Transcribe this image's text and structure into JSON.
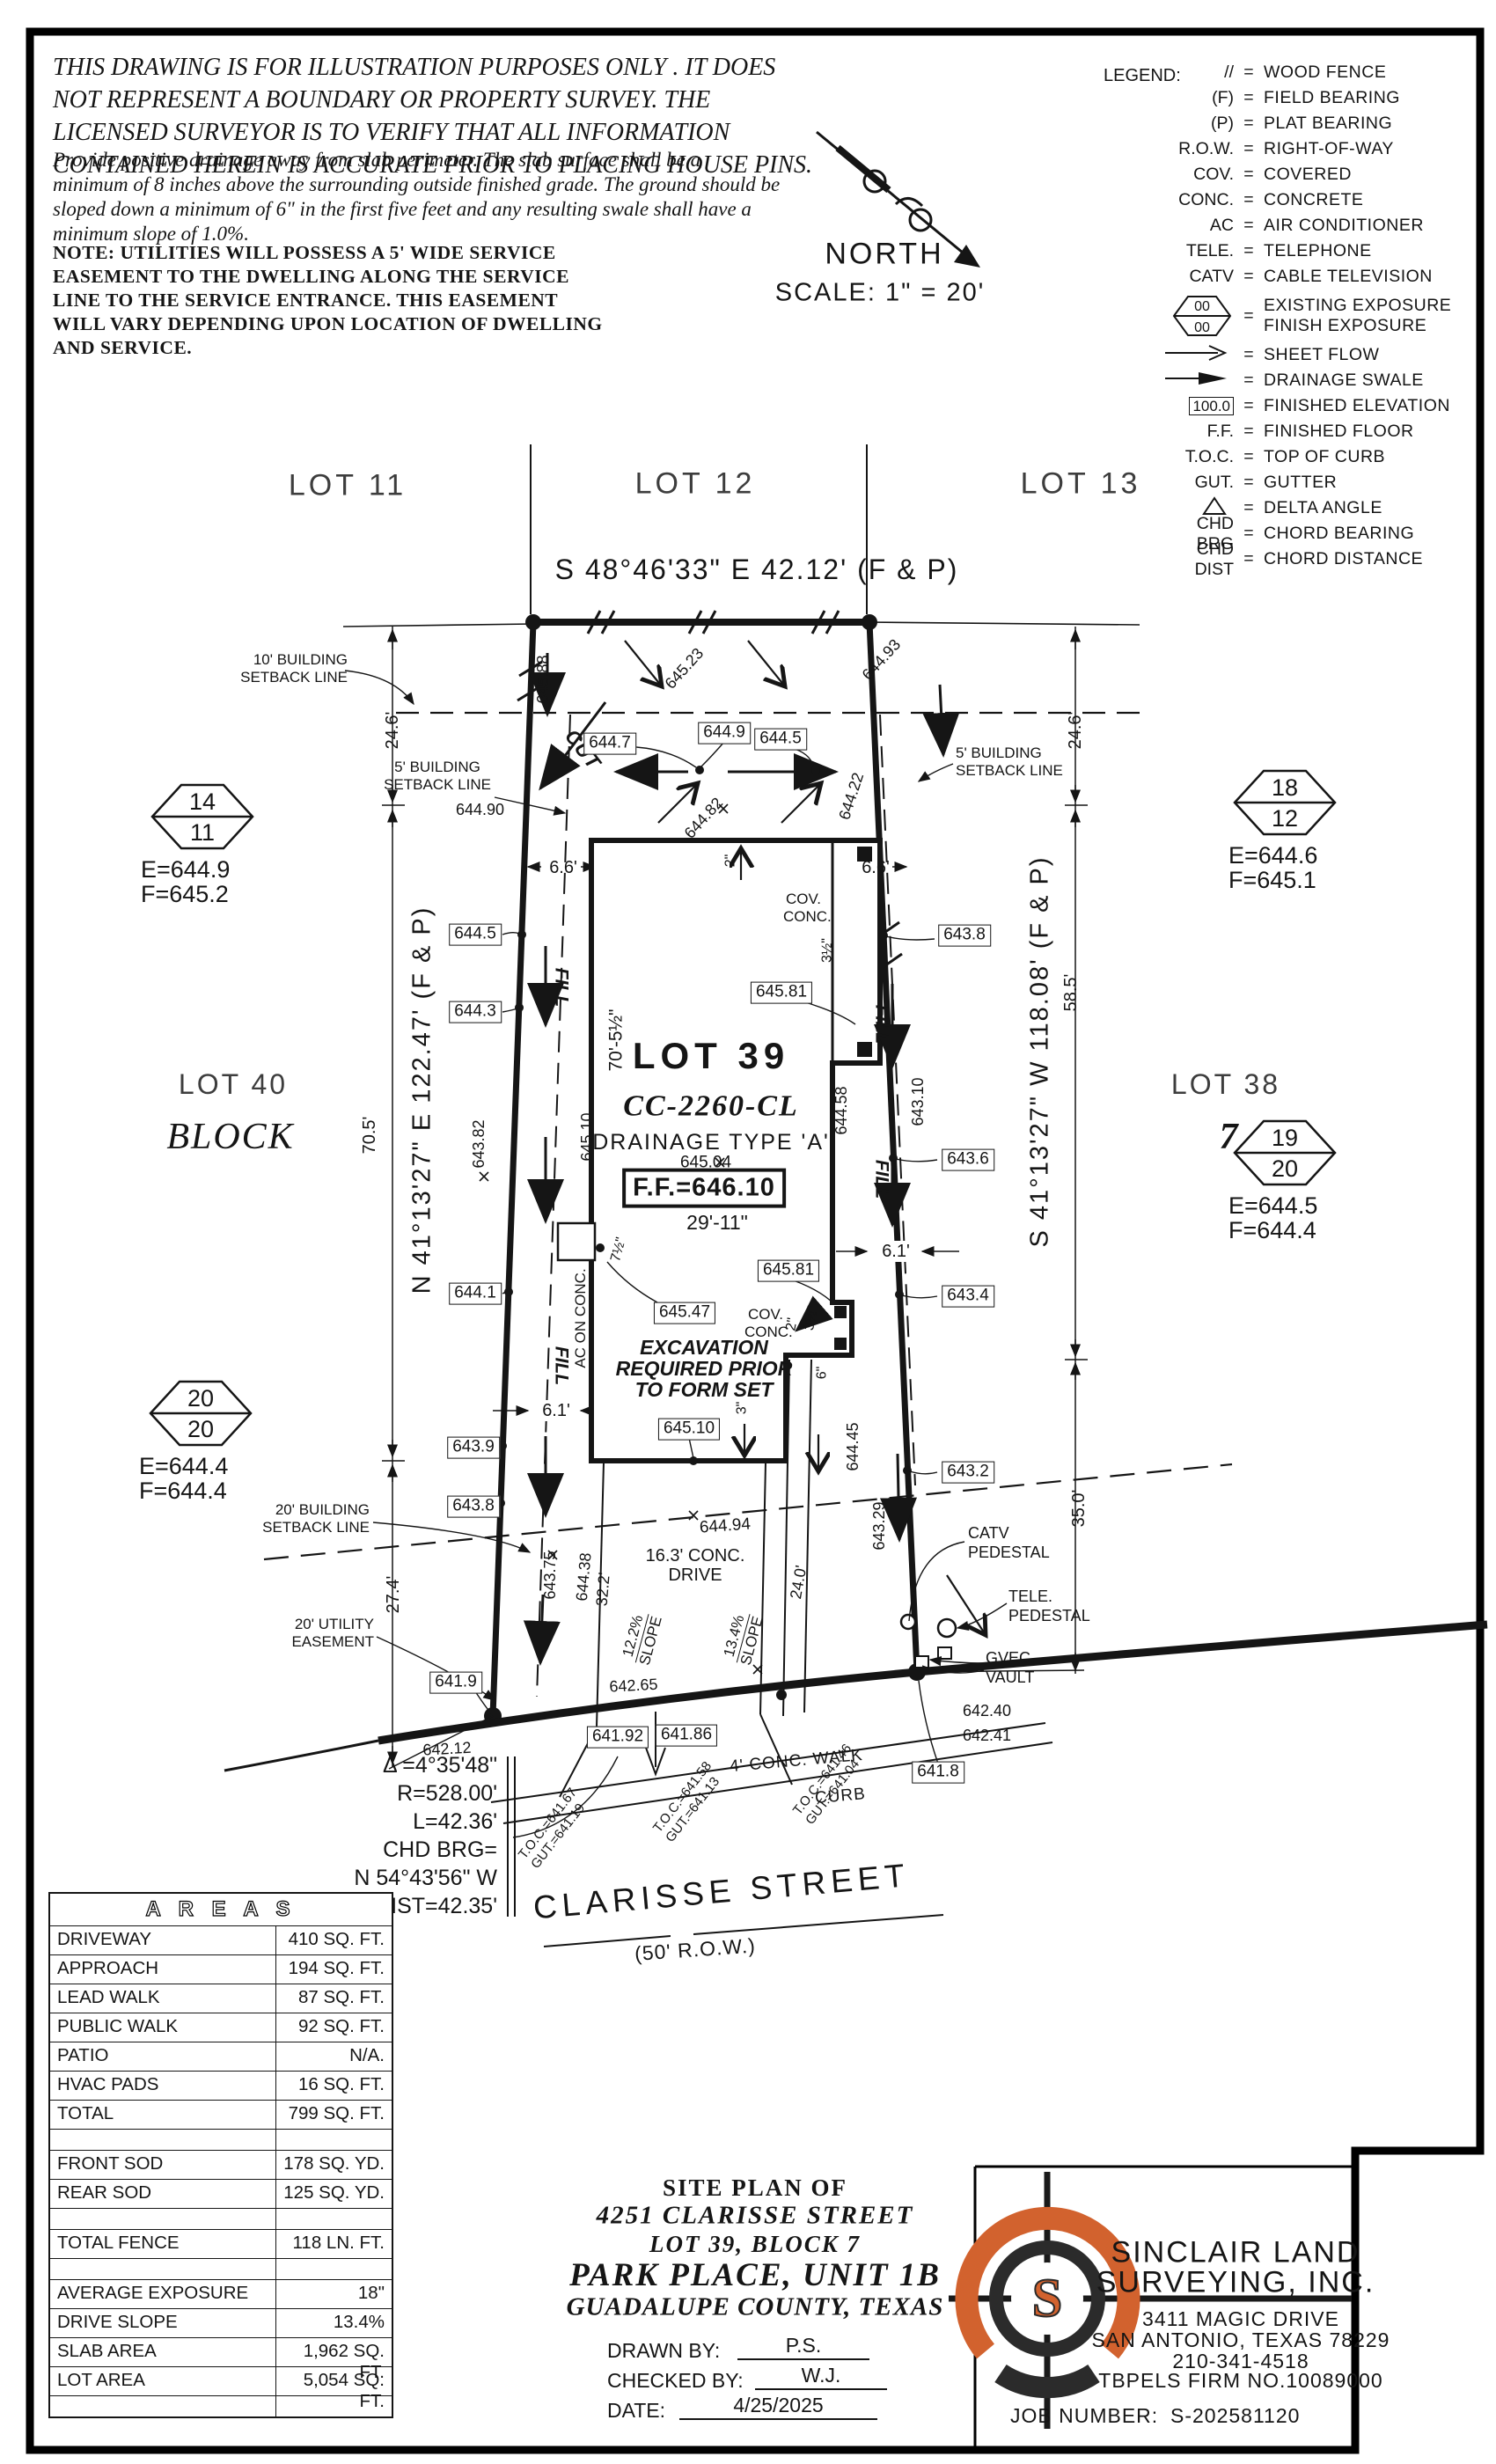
{
  "disclaimer": {
    "p1": [
      "THIS DRAWING IS FOR ILLUSTRATION PURPOSES ONLY . IT DOES",
      "NOT REPRESENT A BOUNDARY OR PROPERTY SURVEY. THE",
      "LICENSED SURVEYOR IS TO VERIFY THAT ALL INFORMATION",
      "CONTAINED HEREIN IS ACCURATE PRIOR TO PLACING HOUSE PINS."
    ],
    "p2": [
      "Provide positive drainage away from slab perimeter. The slab surface shall be a",
      "minimum of 8 inches above the surrounding outside finished grade. The ground should be",
      "sloped down a minimum of 6\" in the first five feet and any resulting swale shall have a",
      "minimum slope of 1.0%."
    ],
    "p3": [
      "NOTE: UTILITIES WILL POSSESS A 5' WIDE SERVICE",
      "EASEMENT TO THE DWELLING ALONG THE SERVICE",
      "LINE TO THE SERVICE ENTRANCE. THIS EASEMENT",
      "WILL VARY DEPENDING UPON LOCATION OF DWELLING",
      "AND SERVICE."
    ]
  },
  "north": {
    "label": "NORTH",
    "scale": "SCALE: 1\" = 20'"
  },
  "legend": {
    "title": "LEGEND:",
    "eq": "=",
    "rows": [
      {
        "sym": "//",
        "label": "WOOD FENCE"
      },
      {
        "sym": "(F)",
        "label": "FIELD BEARING"
      },
      {
        "sym": "(P)",
        "label": "PLAT BEARING"
      },
      {
        "sym": "R.O.W.",
        "label": "RIGHT-OF-WAY"
      },
      {
        "sym": "COV.",
        "label": "COVERED"
      },
      {
        "sym": "CONC.",
        "label": "CONCRETE"
      },
      {
        "sym": "AC",
        "label": "AIR CONDITIONER"
      },
      {
        "sym": "TELE.",
        "label": "TELEPHONE"
      },
      {
        "sym": "CATV",
        "label": "CABLE TELEVISION"
      }
    ],
    "exposure": {
      "top": "00",
      "bottom": "00",
      "label1": "EXISTING EXPOSURE",
      "label2": "FINISH EXPOSURE"
    },
    "rows2": [
      {
        "sym": "",
        "label": "SHEET FLOW"
      },
      {
        "sym": "",
        "label": "DRAINAGE SWALE"
      },
      {
        "sym": "100.0",
        "label": "FINISHED ELEVATION"
      },
      {
        "sym": "F.F.",
        "label": "FINISHED FLOOR"
      },
      {
        "sym": "T.O.C.",
        "label": "TOP OF CURB"
      },
      {
        "sym": "GUT.",
        "label": "GUTTER"
      },
      {
        "sym": "",
        "label": "DELTA ANGLE"
      },
      {
        "sym": "CHD BRG",
        "label": "CHORD BEARING"
      },
      {
        "sym": "CHD DIST",
        "label": "CHORD DISTANCE"
      }
    ]
  },
  "lots": {
    "lot11": "LOT 11",
    "lot12": "LOT 12",
    "lot13": "LOT 13",
    "lot40": "LOT 40",
    "block_word": "BLOCK",
    "lot38": "LOT 38",
    "block_num": "7",
    "lot39": "LOT 39",
    "plan": "CC-2260-CL",
    "drainage": "DRAINAGE TYPE 'A'",
    "ff": "F.F.=646.10"
  },
  "bearings": {
    "rear": "S 48°46'33\" E 42.12' (F & P)",
    "left": "N 41°13'27\" E 122.47' (F & P)",
    "right": "S 41°13'27\" W 118.08' (F & P)"
  },
  "curve": {
    "l1": "Δ =4°35'48\"",
    "l2": "R=528.00'",
    "l3": "L=42.36'",
    "l4": "CHD BRG=",
    "l5": "N 54°43'56\" W",
    "l6": "CHD DIST=42.35'"
  },
  "dims": {
    "rear_left": "24.6'",
    "rear_right": "24.6'",
    "left_mid": "70.5'",
    "left_front": "27.4'",
    "right_mid": "58.5'",
    "right_front": "35.0'",
    "house_depth": "70'-5½\"",
    "house_width": "29'-11\"",
    "side_left": "6.6'",
    "side_right": "6.6'",
    "front_left": "6.1'",
    "front_right": "6.1'",
    "drive_len": "32.2'",
    "drive_right": "24.0'",
    "porch_rear": "3½\"",
    "porch_f2": "2\"",
    "porch_f35": "3½\"",
    "step2": "2\"",
    "porch_f6": "6\"",
    "step3": "3\"",
    "ac_off": "7½\""
  },
  "markers": [
    {
      "top": "14",
      "bottom": "11",
      "e": "E=644.9",
      "f": "F=645.2"
    },
    {
      "top": "18",
      "bottom": "12",
      "e": "E=644.6",
      "f": "F=645.1"
    },
    {
      "top": "20",
      "bottom": "20",
      "e": "E=644.4",
      "f": "F=644.4"
    },
    {
      "top": "19",
      "bottom": "20",
      "e": "E=644.5",
      "f": "F=644.4"
    }
  ],
  "boxed": {
    "b1": "644.7",
    "b2": "644.9",
    "b3": "644.5",
    "l1": "644.5",
    "l2": "644.3",
    "l3": "644.1",
    "l4": "643.9",
    "l5": "643.8",
    "l6": "641.9",
    "r1": "643.8",
    "r2": "643.6",
    "r3": "643.4",
    "r4": "643.2",
    "r5": "641.8",
    "f1": "645.47",
    "f2": "645.81",
    "f3": "645.81",
    "f4": "645.10",
    "f5": "641.92",
    "f6": "641.86"
  },
  "spots": {
    "s1": "645.88",
    "s2": "645.23",
    "s3": "644.93",
    "s4": "644.90",
    "s5": "644.82",
    "s6": "644.22",
    "s7": "645.04",
    "s8": "644.58",
    "s9": "643.10",
    "s10": "643.82",
    "s11": "645.10",
    "s12": "644.45",
    "s13": "643.29",
    "s14": "643.75",
    "s15": "644.38",
    "s16": "644.94",
    "s17": "642.65",
    "s18": "642.12",
    "s19": "642.40",
    "s20": "642.41"
  },
  "toc": {
    "t1a": "T.O.C.=641.67",
    "t1b": "GUT.=641.19",
    "t2a": "T.O.C.=641.58",
    "t2b": "GUT.=641.13",
    "t3a": "T.O.C.=641.46",
    "t3b": "GUT.=641.04"
  },
  "notes": {
    "setback10a": "10' BUILDING",
    "setback10b": "SETBACK LINE",
    "setback5a": "5' BUILDING",
    "setback5b": "SETBACK LINE",
    "setback20a": "20' BUILDING",
    "setback20b": "SETBACK LINE",
    "easementa": "20' UTILITY",
    "easementb": "EASEMENT",
    "cut": "CUT",
    "fill": "FILL",
    "ac": "AC ON CONC.",
    "cov1": "COV.",
    "cov2": "CONC.",
    "exc1": "EXCAVATION",
    "exc2": "REQUIRED PRIOR",
    "exc3": "TO FORM SET",
    "drive1": "16.3' CONC.",
    "drive2": "DRIVE",
    "slope1a": "12.2%",
    "slope1b": "SLOPE",
    "slope2a": "13.4%",
    "slope2b": "SLOPE",
    "walk": "4' CONC. WALK",
    "curb": "CURB",
    "catv1": "CATV",
    "catv2": "PEDESTAL",
    "tele1": "TELE.",
    "tele2": "PEDESTAL",
    "gvec1": "GVEC.",
    "gvec2": "VAULT"
  },
  "street": {
    "name": "CLARISSE STREET",
    "row": "(50' R.O.W.)"
  },
  "areas": {
    "title": "A R E A S",
    "rows": [
      {
        "label": "DRIVEWAY",
        "value": "410 SQ. FT."
      },
      {
        "label": "APPROACH",
        "value": "194 SQ. FT."
      },
      {
        "label": "LEAD WALK",
        "value": "87 SQ. FT."
      },
      {
        "label": "PUBLIC WALK",
        "value": "92 SQ. FT."
      },
      {
        "label": "PATIO",
        "value": "N/A."
      },
      {
        "label": "HVAC PADS",
        "value": "16 SQ. FT."
      },
      {
        "label": "TOTAL",
        "value": "799 SQ. FT."
      },
      {
        "label": "",
        "value": ""
      },
      {
        "label": "FRONT SOD",
        "value": "178 SQ. YD."
      },
      {
        "label": "REAR SOD",
        "value": "125 SQ. YD."
      },
      {
        "label": "",
        "value": ""
      },
      {
        "label": "TOTAL FENCE",
        "value": "118 LN. FT."
      },
      {
        "label": "",
        "value": ""
      },
      {
        "label": "AVERAGE EXPOSURE",
        "value": "18\""
      },
      {
        "label": "DRIVE SLOPE",
        "value": "13.4%"
      },
      {
        "label": "SLAB AREA",
        "value": "1,962 SQ. FT."
      },
      {
        "label": "LOT AREA",
        "value": "5,054 SQ. FT."
      },
      {
        "label": "",
        "value": ""
      }
    ]
  },
  "title_block": {
    "l1": "SITE PLAN OF",
    "l2": "4251 CLARISSE STREET",
    "l3": "LOT 39, BLOCK 7",
    "l4": "PARK PLACE, UNIT 1B",
    "l5": "GUADALUPE COUNTY, TEXAS",
    "drawn_label": "DRAWN BY:",
    "drawn": "P.S.",
    "checked_label": "CHECKED BY:",
    "checked": "W.J.",
    "date_label": "DATE:",
    "date": "4/25/2025"
  },
  "company": {
    "name1": "SINCLAIR LAND",
    "name2": "SURVEYING, INC.",
    "addr1": "3411 MAGIC DRIVE",
    "addr2": "SAN ANTONIO, TEXAS 78229",
    "phone": "210-341-4518",
    "firm": "TBPELS FIRM NO.10089000",
    "job_label": "JOB NUMBER:",
    "job": "S-202581120",
    "logo_letter": "S",
    "accent": "#d2622e"
  }
}
